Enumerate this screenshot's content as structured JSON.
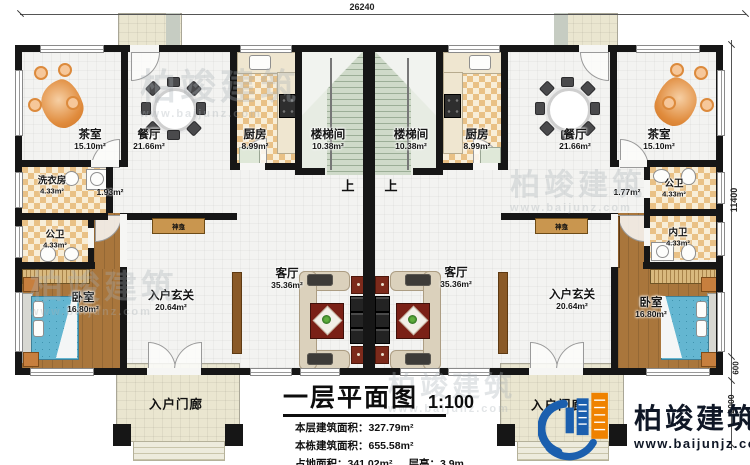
{
  "dimensions": {
    "top_width": "26240",
    "right_main": "11400",
    "right_step": "600",
    "right_porch": "2000"
  },
  "rooms": [
    {
      "name": "茶室",
      "area": "15.10m²"
    },
    {
      "name": "餐厅",
      "area": "21.66m²"
    },
    {
      "name": "厨房",
      "area": "8.99m²"
    },
    {
      "name": "楼梯间",
      "area": "10.38m²"
    },
    {
      "name": "楼梯间",
      "area": "10.38m²"
    },
    {
      "name": "厨房",
      "area": "8.99m²"
    },
    {
      "name": "餐厅",
      "area": "21.66m²"
    },
    {
      "name": "茶室",
      "area": "15.10m²"
    },
    {
      "name": "洗衣房",
      "area": "4.33m²"
    },
    {
      "name": "公卫",
      "area": "4.33m²"
    },
    {
      "name": "公卫",
      "area": "4.33m²"
    },
    {
      "name": "内卫",
      "area": "4.33m²"
    },
    {
      "name": "卧室",
      "area": "16.80m²"
    },
    {
      "name": "卧室",
      "area": "16.80m²"
    },
    {
      "name": "入户玄关",
      "area": "20.64m²"
    },
    {
      "name": "入户玄关",
      "area": "20.64m²"
    },
    {
      "name": "客厅",
      "area": "35.36m²"
    },
    {
      "name": "客厅",
      "area": "35.36m²"
    }
  ],
  "small_areas": {
    "corridor_left": "1.93m²",
    "corridor_right": "1.77m²"
  },
  "features": {
    "shrine": "神龛",
    "stairs_up": "上",
    "entry_porch": "入户门廊"
  },
  "title_block": {
    "title": "一层平面图",
    "scale": "1:100",
    "floor_area_label": "本层建筑面积：",
    "floor_area_value": "327.79m²",
    "building_area_label": "本栋建筑面积：",
    "building_area_value": "655.58m²",
    "footprint_label": "占地面积：",
    "footprint_value": "341.02m²",
    "height_label": "层高：",
    "height_value": "3.9m"
  },
  "brand": {
    "name": "柏竣建筑",
    "website": "www.baijunjz.com"
  },
  "watermark": {
    "text": "柏竣建筑",
    "subtext": "www.baijunz.com"
  },
  "colors": {
    "wall": "#161616",
    "tile_dark": "#e9c186",
    "tile_light": "#f8eed8",
    "wood": "#a9763c",
    "stair": "#cfdac9",
    "porch": "#eae6d0",
    "bed_blue": "#64b6d1",
    "sofa": "#dbd1bc",
    "rug_red": "#7a2016",
    "plant_green": "#3e8d2e",
    "brand_blue": "#1b5fae",
    "brand_orange": "#ef8200",
    "shrine_tan": "#c9964f"
  }
}
